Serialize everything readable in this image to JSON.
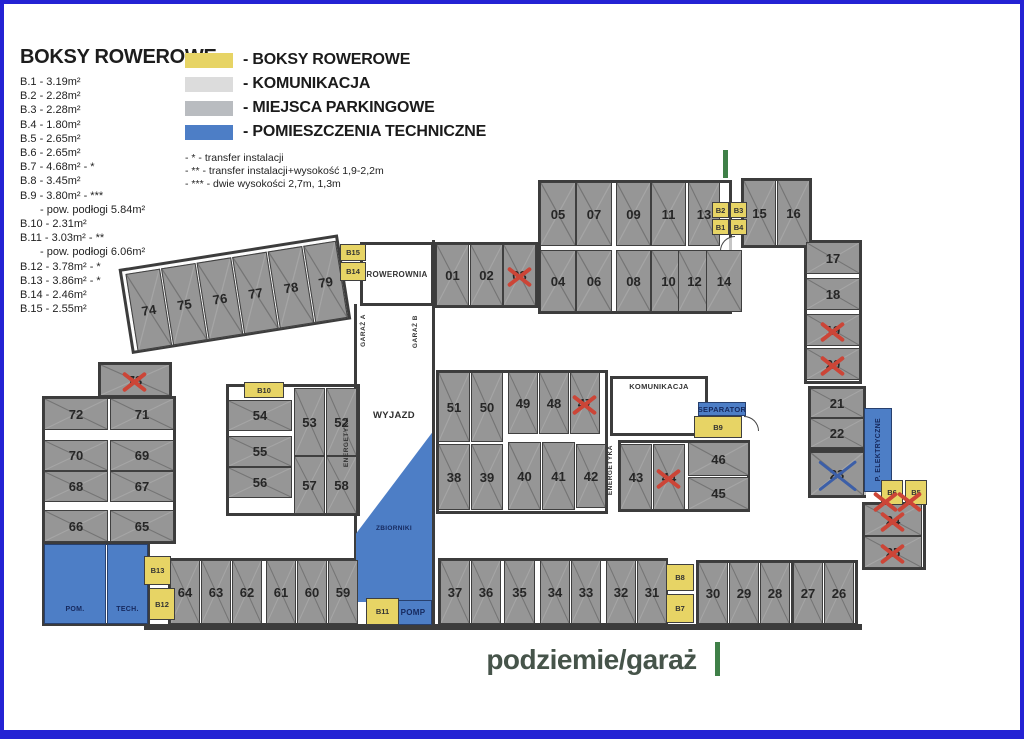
{
  "colors": {
    "frame": "#2422d4",
    "wall": "#3c3c3c",
    "parking": "#969696",
    "bike_box": "#e7d465",
    "komunikacja_swatch": "#dcdcdc",
    "parking_swatch": "#b9bcc0",
    "technical": "#4d7ec6",
    "cross_red": "#cc4537",
    "cross_blue": "#3c5fa8",
    "green_mark": "#3f8048"
  },
  "legend": {
    "title": "BOKSY ROWEROWE",
    "items": [
      {
        "t": "B.1  - 3.19m²",
        "ind": false
      },
      {
        "t": "B.2  - 2.28m²",
        "ind": false
      },
      {
        "t": "B.3  - 2.28m²",
        "ind": false
      },
      {
        "t": "B.4  - 1.80m²",
        "ind": false
      },
      {
        "t": "B.5  - 2.65m²",
        "ind": false
      },
      {
        "t": "B.6  - 2.65m²",
        "ind": false
      },
      {
        "t": "B.7  - 4.68m² - *",
        "ind": false
      },
      {
        "t": "B.8  - 3.45m²",
        "ind": false
      },
      {
        "t": "B.9  - 3.80m² - ***",
        "ind": false
      },
      {
        "t": "- pow. podłogi 5.84m²",
        "ind": true
      },
      {
        "t": "B.10 - 2.31m²",
        "ind": false
      },
      {
        "t": "B.11 - 3.03m² - **",
        "ind": false
      },
      {
        "t": "- pow. podłogi 6.06m²",
        "ind": true
      },
      {
        "t": "B.12 - 3.78m² - *",
        "ind": false
      },
      {
        "t": "B.13 - 3.86m² - *",
        "ind": false
      },
      {
        "t": "B.14 - 2.46m²",
        "ind": false
      },
      {
        "t": "B.15 - 2.55m²",
        "ind": false
      }
    ],
    "swatches": [
      {
        "label": "- BOKSY ROWEROWE",
        "color": "#e7d465"
      },
      {
        "label": "- KOMUNIKACJA",
        "color": "#dcdcdc"
      },
      {
        "label": "- MIEJSCA PARKINGOWE",
        "color": "#b9bcc0"
      },
      {
        "label": "- POMIESZCZENIA TECHNICZNE",
        "color": "#4d7ec6"
      }
    ],
    "notes": [
      "- * - transfer instalacji",
      "- ** - transfer instalacji+wysokość 1,9-2,2m",
      "- *** - dwie wysokości 2,7m, 1,3m"
    ]
  },
  "footer": {
    "label": "podziemie/garaż"
  },
  "plan": {
    "spots": [
      {
        "n": "01",
        "r": [
          432,
          240,
          33,
          62
        ]
      },
      {
        "n": "02",
        "r": [
          466,
          240,
          33,
          62
        ]
      },
      {
        "n": "03",
        "r": [
          499,
          240,
          33,
          62
        ],
        "cross": "red"
      },
      {
        "n": "05",
        "r": [
          536,
          178,
          36,
          64
        ]
      },
      {
        "n": "07",
        "r": [
          572,
          178,
          36,
          64
        ]
      },
      {
        "n": "09",
        "r": [
          612,
          178,
          35,
          64
        ]
      },
      {
        "n": "11",
        "r": [
          647,
          178,
          35,
          64
        ]
      },
      {
        "n": "13",
        "r": [
          684,
          178,
          32,
          64
        ]
      },
      {
        "n": "04",
        "r": [
          536,
          246,
          36,
          62
        ]
      },
      {
        "n": "06",
        "r": [
          572,
          246,
          36,
          62
        ]
      },
      {
        "n": "08",
        "r": [
          612,
          246,
          35,
          62
        ]
      },
      {
        "n": "10",
        "r": [
          647,
          246,
          35,
          62
        ]
      },
      {
        "n": "12",
        "r": [
          674,
          246,
          33,
          62
        ]
      },
      {
        "n": "14",
        "r": [
          702,
          246,
          36,
          62
        ]
      },
      {
        "n": "15",
        "r": [
          739,
          176,
          33,
          66
        ]
      },
      {
        "n": "16",
        "r": [
          773,
          176,
          33,
          66
        ]
      },
      {
        "n": "17",
        "r": [
          802,
          238,
          54,
          32
        ]
      },
      {
        "n": "18",
        "r": [
          802,
          274,
          54,
          32
        ]
      },
      {
        "n": "19",
        "r": [
          802,
          310,
          54,
          32
        ],
        "cross": "red"
      },
      {
        "n": "20",
        "r": [
          802,
          344,
          54,
          32
        ],
        "cross": "red"
      },
      {
        "n": "21",
        "r": [
          806,
          384,
          54,
          30
        ]
      },
      {
        "n": "22",
        "r": [
          806,
          414,
          54,
          30
        ]
      },
      {
        "n": "23",
        "r": [
          806,
          448,
          54,
          44
        ],
        "cross": "blue"
      },
      {
        "n": "24",
        "r": [
          860,
          500,
          58,
          32
        ],
        "cross": "red"
      },
      {
        "n": "25",
        "r": [
          860,
          532,
          58,
          32
        ],
        "cross": "red"
      },
      {
        "n": "26",
        "r": [
          820,
          558,
          30,
          62
        ]
      },
      {
        "n": "27",
        "r": [
          789,
          558,
          30,
          62
        ]
      },
      {
        "n": "28",
        "r": [
          756,
          558,
          30,
          62
        ]
      },
      {
        "n": "29",
        "r": [
          725,
          558,
          30,
          62
        ]
      },
      {
        "n": "30",
        "r": [
          694,
          558,
          30,
          62
        ]
      },
      {
        "n": "31",
        "r": [
          633,
          556,
          30,
          64
        ]
      },
      {
        "n": "32",
        "r": [
          602,
          556,
          30,
          64
        ]
      },
      {
        "n": "33",
        "r": [
          567,
          556,
          30,
          64
        ]
      },
      {
        "n": "34",
        "r": [
          536,
          556,
          30,
          64
        ]
      },
      {
        "n": "35",
        "r": [
          500,
          556,
          31,
          64
        ]
      },
      {
        "n": "36",
        "r": [
          467,
          556,
          30,
          64
        ]
      },
      {
        "n": "37",
        "r": [
          436,
          556,
          30,
          64
        ]
      },
      {
        "n": "38",
        "r": [
          434,
          440,
          32,
          66
        ]
      },
      {
        "n": "39",
        "r": [
          467,
          440,
          32,
          66
        ]
      },
      {
        "n": "40",
        "r": [
          504,
          438,
          33,
          68
        ]
      },
      {
        "n": "41",
        "r": [
          538,
          438,
          33,
          68
        ]
      },
      {
        "n": "42",
        "r": [
          572,
          440,
          30,
          64
        ]
      },
      {
        "n": "43",
        "r": [
          616,
          440,
          32,
          66
        ]
      },
      {
        "n": "44",
        "r": [
          649,
          440,
          32,
          66
        ],
        "cross": "red"
      },
      {
        "n": "45",
        "r": [
          684,
          473,
          61,
          33
        ]
      },
      {
        "n": "46",
        "r": [
          684,
          438,
          61,
          34
        ]
      },
      {
        "n": "47",
        "r": [
          566,
          368,
          30,
          62
        ],
        "cross": "red"
      },
      {
        "n": "48",
        "r": [
          535,
          368,
          30,
          62
        ]
      },
      {
        "n": "49",
        "r": [
          504,
          368,
          30,
          62
        ]
      },
      {
        "n": "50",
        "r": [
          467,
          368,
          32,
          70
        ]
      },
      {
        "n": "51",
        "r": [
          434,
          368,
          32,
          70
        ]
      },
      {
        "n": "52",
        "r": [
          322,
          384,
          31,
          68
        ]
      },
      {
        "n": "53",
        "r": [
          290,
          384,
          31,
          68
        ]
      },
      {
        "n": "54",
        "r": [
          224,
          396,
          64,
          31
        ]
      },
      {
        "n": "55",
        "r": [
          224,
          432,
          64,
          31
        ]
      },
      {
        "n": "56",
        "r": [
          224,
          463,
          64,
          31
        ]
      },
      {
        "n": "57",
        "r": [
          290,
          452,
          31,
          58
        ]
      },
      {
        "n": "58",
        "r": [
          322,
          452,
          31,
          58
        ]
      },
      {
        "n": "59",
        "r": [
          324,
          556,
          30,
          64
        ]
      },
      {
        "n": "60",
        "r": [
          293,
          556,
          30,
          64
        ]
      },
      {
        "n": "61",
        "r": [
          262,
          556,
          30,
          64
        ]
      },
      {
        "n": "62",
        "r": [
          228,
          556,
          30,
          64
        ]
      },
      {
        "n": "63",
        "r": [
          197,
          556,
          30,
          64
        ]
      },
      {
        "n": "64",
        "r": [
          166,
          556,
          30,
          64
        ]
      },
      {
        "n": "65",
        "r": [
          106,
          506,
          64,
          32
        ]
      },
      {
        "n": "66",
        "r": [
          40,
          506,
          64,
          32
        ]
      },
      {
        "n": "67",
        "r": [
          106,
          467,
          64,
          31
        ]
      },
      {
        "n": "68",
        "r": [
          40,
          467,
          64,
          31
        ]
      },
      {
        "n": "69",
        "r": [
          106,
          436,
          64,
          31
        ]
      },
      {
        "n": "70",
        "r": [
          40,
          436,
          64,
          31
        ]
      },
      {
        "n": "71",
        "r": [
          106,
          394,
          64,
          32
        ]
      },
      {
        "n": "72",
        "r": [
          40,
          394,
          64,
          32
        ]
      },
      {
        "n": "73",
        "r": [
          96,
          360,
          70,
          32
        ],
        "cross": "red"
      },
      {
        "n": "74",
        "r": [
          3,
          3,
          35,
          78
        ],
        "parent": "slant-row"
      },
      {
        "n": "75",
        "r": [
          39,
          3,
          35,
          78
        ],
        "parent": "slant-row"
      },
      {
        "n": "76",
        "r": [
          75,
          3,
          35,
          78
        ],
        "parent": "slant-row"
      },
      {
        "n": "77",
        "r": [
          111,
          3,
          35,
          78
        ],
        "parent": "slant-row"
      },
      {
        "n": "78",
        "r": [
          147,
          3,
          35,
          78
        ],
        "parent": "slant-row"
      },
      {
        "n": "79",
        "r": [
          183,
          3,
          33,
          78
        ],
        "parent": "slant-row"
      }
    ],
    "bike_boxes": [
      {
        "n": "B2",
        "r": [
          708,
          198,
          17,
          16
        ]
      },
      {
        "n": "B3",
        "r": [
          726,
          198,
          17,
          16
        ]
      },
      {
        "n": "B1",
        "r": [
          708,
          215,
          17,
          16
        ]
      },
      {
        "n": "B4",
        "r": [
          726,
          215,
          17,
          16
        ]
      },
      {
        "n": "B15",
        "r": [
          336,
          240,
          26,
          17
        ]
      },
      {
        "n": "B14",
        "r": [
          336,
          258,
          26,
          19
        ]
      },
      {
        "n": "B10",
        "r": [
          240,
          378,
          40,
          16
        ]
      },
      {
        "n": "B9",
        "r": [
          690,
          412,
          48,
          22
        ]
      },
      {
        "n": "B13",
        "r": [
          140,
          552,
          27,
          29
        ]
      },
      {
        "n": "B12",
        "r": [
          145,
          584,
          26,
          32
        ]
      },
      {
        "n": "B11",
        "r": [
          362,
          594,
          33,
          27
        ]
      },
      {
        "n": "B8",
        "r": [
          662,
          560,
          28,
          27
        ]
      },
      {
        "n": "B7",
        "r": [
          662,
          590,
          28,
          29
        ]
      },
      {
        "n": "B6",
        "r": [
          877,
          476,
          22,
          25
        ]
      },
      {
        "n": "B5",
        "r": [
          901,
          476,
          22,
          25
        ]
      }
    ],
    "rooms": [
      {
        "label": "ROWEROWNIA",
        "r": [
          356,
          238,
          74,
          64
        ],
        "fill": "white",
        "cls": "room-border"
      },
      {
        "label": "WYJAZD",
        "r": [
          358,
          400,
          64,
          22
        ],
        "fill": "none",
        "cls": "wyjazd"
      },
      {
        "label": "ZBIORNIKI",
        "r": [
          352,
          418,
          76,
          180
        ],
        "fill": "technical",
        "cls": "zbiorniki"
      },
      {
        "label": "POMP",
        "r": [
          390,
          596,
          38,
          25
        ],
        "fill": "technical"
      },
      {
        "label": "POM.",
        "r": [
          40,
          540,
          62,
          80
        ],
        "fill": "technical",
        "cls": "label-bottom"
      },
      {
        "label": "TECH.",
        "r": [
          103,
          540,
          41,
          80
        ],
        "fill": "technical",
        "cls": "label-bottom"
      },
      {
        "label": "KOMUNIKACJA",
        "r": [
          606,
          372,
          98,
          60
        ],
        "fill": "white",
        "cls": "room-border label-top"
      },
      {
        "label": "SEPARATOR",
        "r": [
          694,
          398,
          48,
          14
        ],
        "fill": "technical",
        "cls": "sep"
      },
      {
        "label": "P. ELEKTRYCZNE",
        "r": [
          860,
          404,
          28,
          84
        ],
        "fill": "technical",
        "cls": "vert room-border"
      }
    ],
    "vertical_labels": [
      {
        "text": "GARAŻ A",
        "r": [
          352,
          300,
          14,
          52
        ]
      },
      {
        "text": "GARAŻ B",
        "r": [
          404,
          302,
          14,
          52
        ]
      },
      {
        "text": "ENERGETYKA",
        "r": [
          337,
          414,
          10,
          48
        ]
      },
      {
        "text": "ENERGETYKA",
        "r": [
          601,
          438,
          10,
          56
        ]
      }
    ],
    "extra_crosses": [
      {
        "c": "red",
        "r": [
          872,
          488,
          20,
          16
        ]
      },
      {
        "c": "red",
        "r": [
          896,
          488,
          20,
          16
        ]
      }
    ],
    "green_marks": [
      [
        719,
        146,
        5,
        28
      ],
      [
        711,
        638,
        5,
        34
      ]
    ]
  }
}
